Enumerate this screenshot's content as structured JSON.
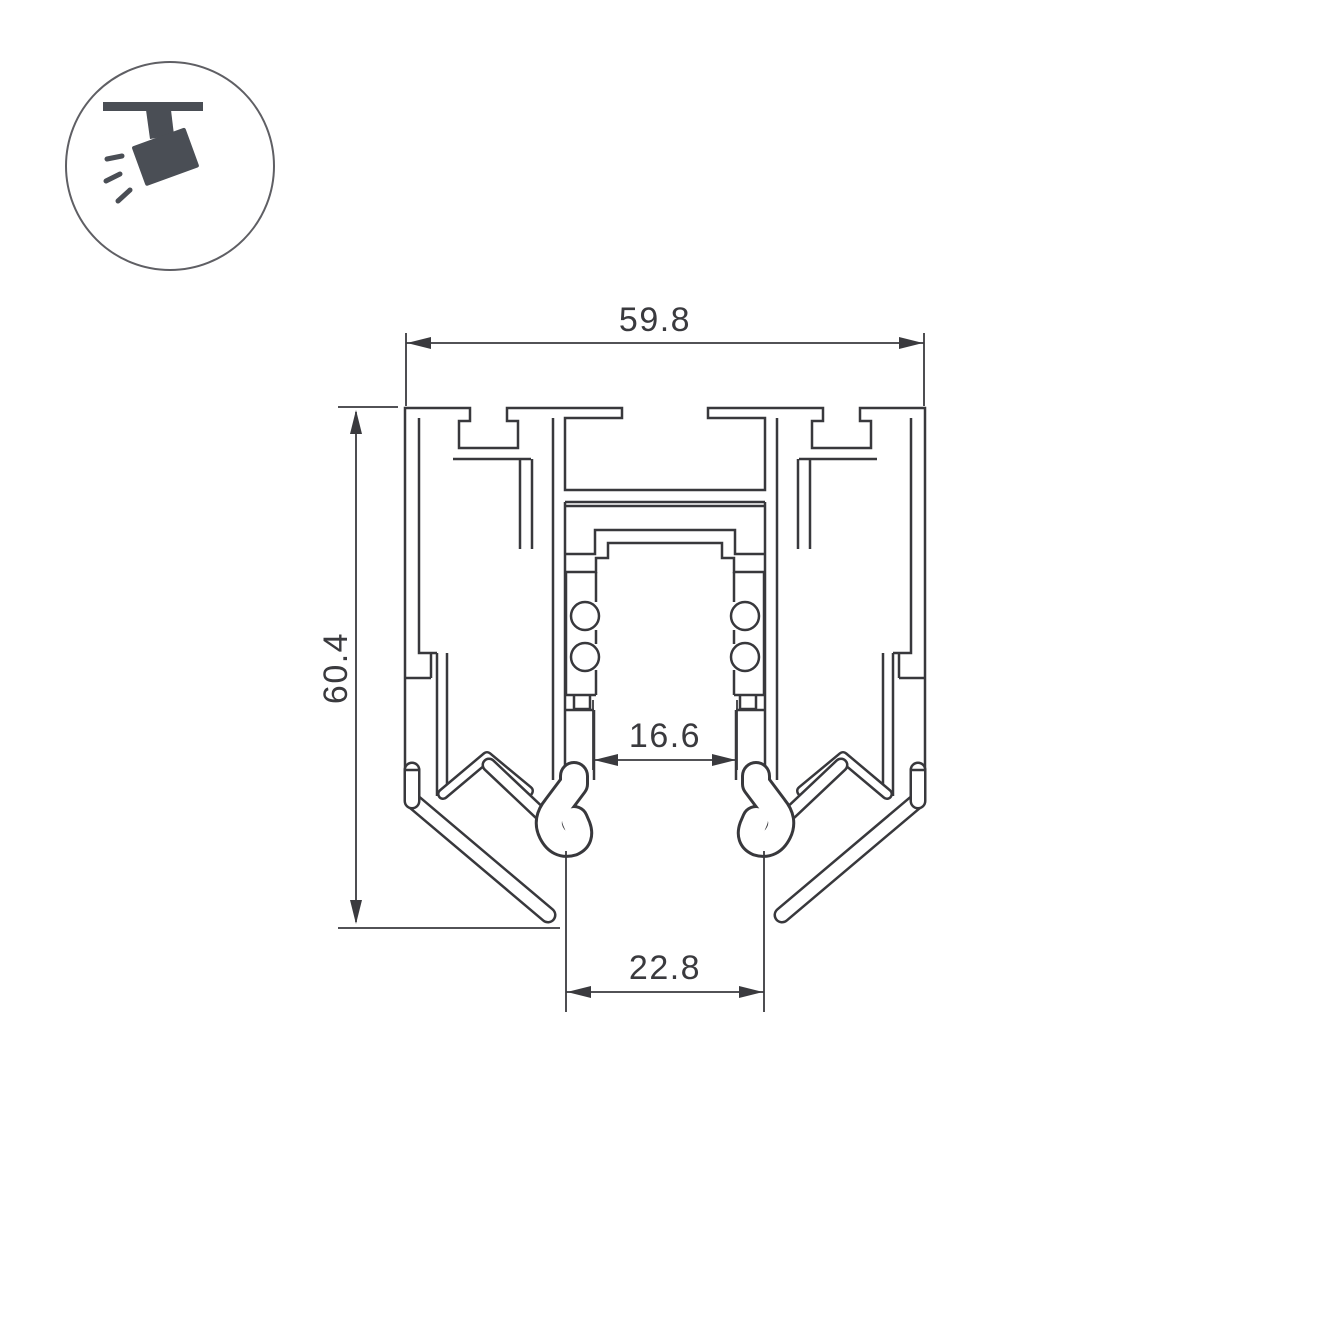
{
  "page": {
    "background_color": "#ffffff",
    "description_text": ""
  },
  "badge": {
    "icon": "ceiling-track-spotlight-icon",
    "icon_color": "#4a4e55",
    "ring_color": "#5f5f64"
  },
  "drawing": {
    "type": "extrusion-profile-cross-section",
    "line_color": "#38383c",
    "dimensions": {
      "width_top": {
        "value": "59.8",
        "position": "top"
      },
      "height_left": {
        "value": "60.4",
        "position": "left"
      },
      "inner_width": {
        "value": "16.6",
        "position": "middle"
      },
      "bottom_width": {
        "value": "22.8",
        "position": "bottom"
      }
    }
  }
}
